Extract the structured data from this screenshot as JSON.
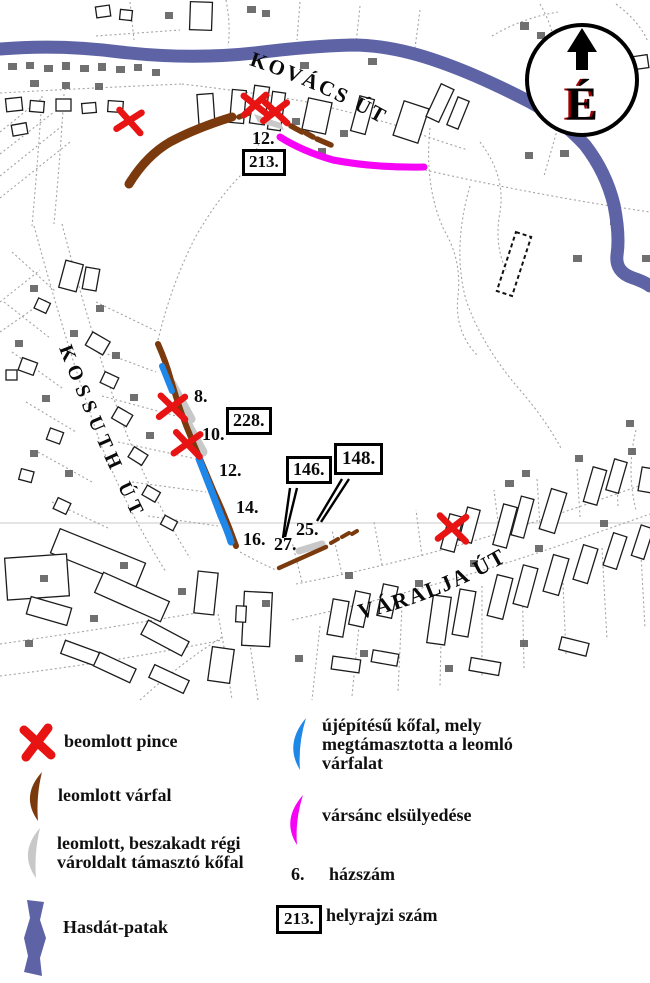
{
  "figure": {
    "type": "annotated cadastral damage map"
  },
  "map": {
    "north_indicator": "É",
    "streets": {
      "kovacs": "KOVÁCS ÚT",
      "kossuth": "KOSSUTH ÚT",
      "varalja": "VÁRALJA ÚT"
    },
    "house_numbers": {
      "kovacs_12": "12.",
      "kossuth_8": "8.",
      "kossuth_10": "10.",
      "kossuth_12": "12.",
      "kossuth_14": "14.",
      "kossuth_16": "16.",
      "varalja_25": "25.",
      "varalja_27": "27."
    },
    "parcel_numbers": {
      "p213": "213.",
      "p228": "228.",
      "p146": "146.",
      "p148": "148."
    }
  },
  "legend": {
    "collapsed_cellar": "beomlott pince",
    "collapsed_castle_wall": "leomlott várfal",
    "old_support_wall_line1": "leomlott, beszakadt régi",
    "old_support_wall_line2": "vároldalt támasztó kőfal",
    "stream": "Hasdát-patak",
    "new_stone_wall_line1": "újépítésű kőfal, mely",
    "new_stone_wall_line2": "megtámasztotta a leomló",
    "new_stone_wall_line3": "várfalat",
    "moat_subsidence": "vársánc elsülyedése",
    "house_number_sample": "6.",
    "house_number_label": "házszám",
    "parcel_number_sample": "213.",
    "parcel_number_label": "helyrajzi szám"
  },
  "colors": {
    "collapsed_cellar_red": "#e81313",
    "castle_wall_brown": "#7a3a0d",
    "old_wall_gray": "#c8c8c8",
    "new_wall_blue": "#1e87e8",
    "moat_magenta": "#f504f5",
    "stream_blue": "#5d63a5"
  }
}
